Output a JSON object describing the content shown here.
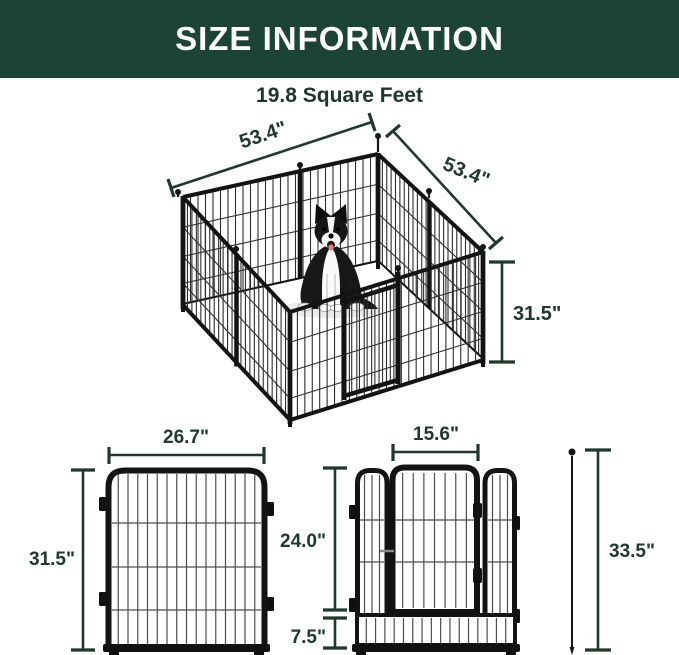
{
  "header": {
    "title": "SIZE INFORMATION"
  },
  "subtitle": "19.8 Square Feet",
  "colors": {
    "header_bg": "#1c4434",
    "dimension_line": "#20382e",
    "frame_black": "#131313"
  },
  "pen3d": {
    "width_left": "53.4\"",
    "width_right": "53.4\"",
    "height": "31.5\""
  },
  "front_panel": {
    "width": "26.7\"",
    "height": "31.5\""
  },
  "door_panel": {
    "door_width": "15.6\"",
    "door_height": "24.0\"",
    "bottom_height": "7.5\"",
    "total_height": "33.5\""
  }
}
